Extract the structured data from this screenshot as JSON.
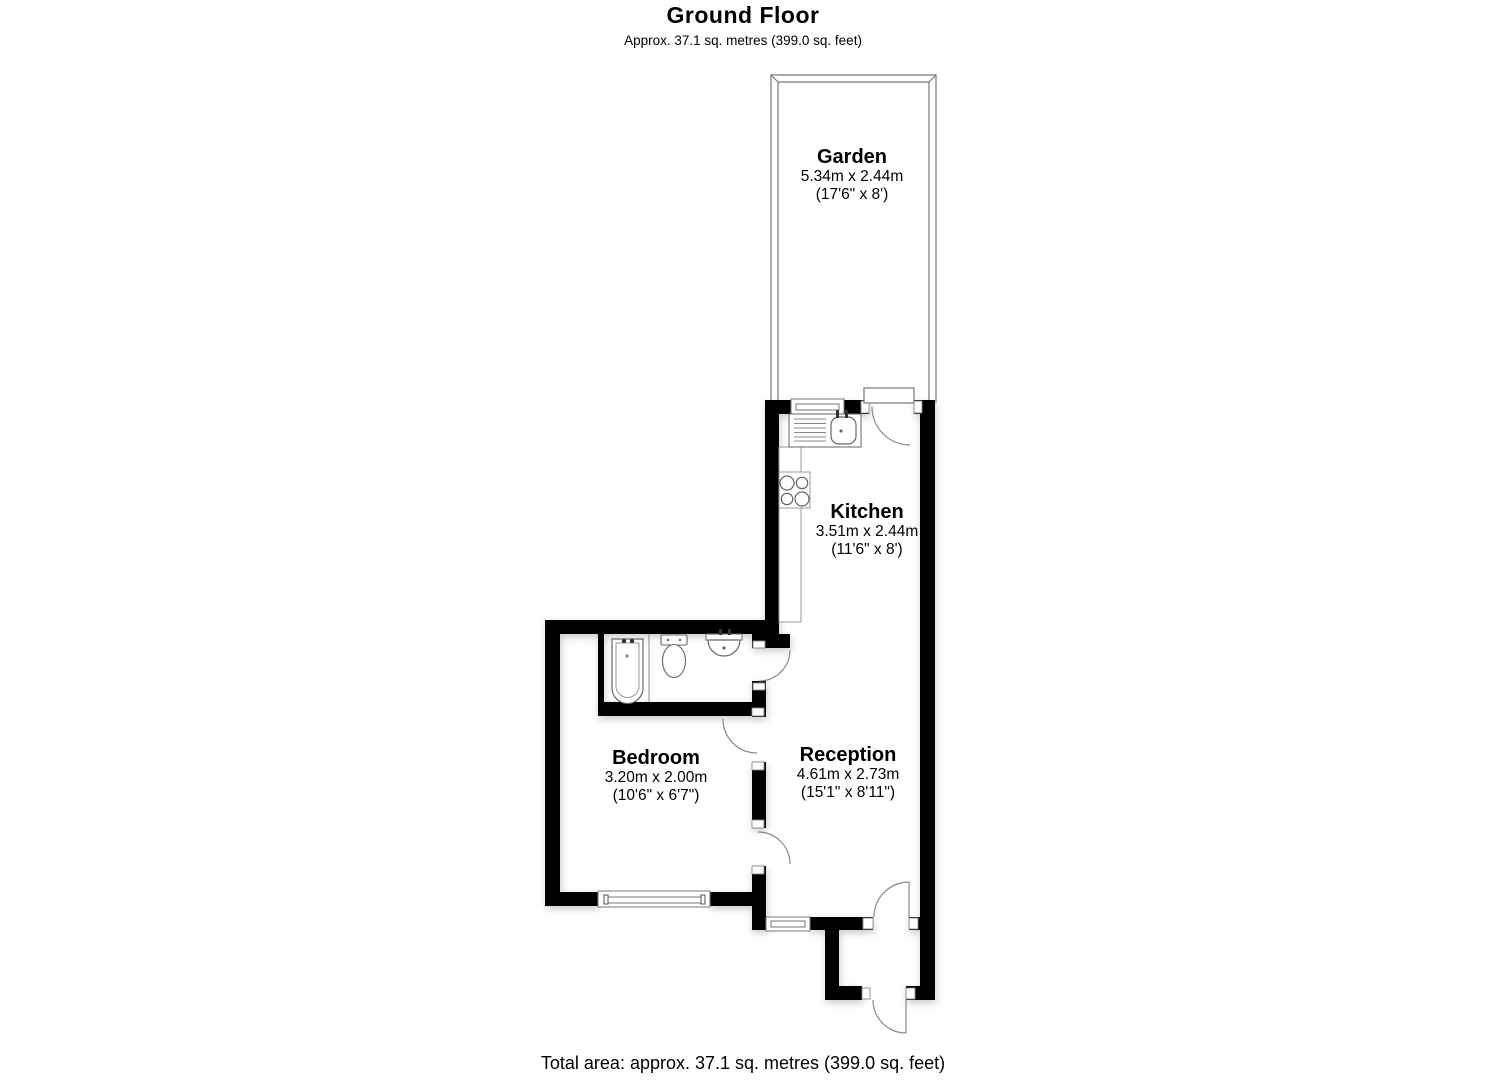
{
  "header": {
    "title": "Ground Floor",
    "subtitle": "Approx. 37.1 sq. metres (399.0 sq. feet)"
  },
  "rooms": {
    "garden": {
      "name": "Garden",
      "metric": "5.34m x 2.44m",
      "imperial": "(17'6\" x 8')"
    },
    "kitchen": {
      "name": "Kitchen",
      "metric": "3.51m x 2.44m",
      "imperial": "(11'6\" x 8')"
    },
    "bedroom": {
      "name": "Bedroom",
      "metric": "3.20m x 2.00m",
      "imperial": "(10'6\" x 6'7\")"
    },
    "reception": {
      "name": "Reception",
      "metric": "4.61m x 2.73m",
      "imperial": "(15'1\" x 8'11\")"
    }
  },
  "footer": {
    "total_area": "Total area: approx. 37.1 sq. metres (399.0 sq. feet)"
  },
  "fixtures": [
    "kitchen-sink",
    "kitchen-counter",
    "hob",
    "bath",
    "toilet",
    "wash-basin"
  ],
  "features": {
    "doors": 6,
    "windows": 3,
    "garden_fence": true
  },
  "colors": {
    "wall": "#000000",
    "outline": "#777777",
    "fixture_outline": "#666666",
    "background": "#ffffff",
    "text": "#000000"
  }
}
